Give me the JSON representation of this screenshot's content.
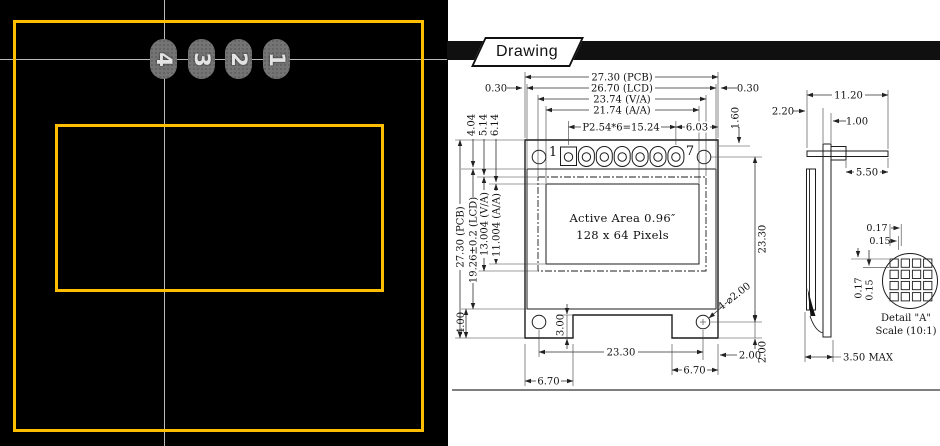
{
  "photo": {
    "pad_labels": [
      "4",
      "3",
      "2",
      "1"
    ],
    "colors": {
      "outline_yellow": "#FFBE00",
      "background": "#000000",
      "pad_gray": "#747474",
      "guide_line": "#DCDCDC"
    }
  },
  "banner": {
    "label": "Drawing"
  },
  "front_view": {
    "pin_first": "1",
    "pin_last": "7",
    "active_line1": "Active Area 0.96″",
    "active_line2": "128 x 64 Pixels",
    "dim_pcb_w": "27.30 (PCB)",
    "dim_lcd_w": "26.70 (LCD)",
    "dim_va_w": "23.74 (V/A)",
    "dim_aa_w": "21.74 (A/A)",
    "dim_pitch": "P2.54*6=15.24",
    "dim_pin_edge": "6.03",
    "dim_edge_l": "0.30",
    "dim_edge_r": "0.30",
    "dim_pin_top": "1.60",
    "dim_pcb_h": "27.30 (PCB)",
    "dim_lcd_h": "19.26±0.2 (LCD)",
    "dim_va_h": "13.004 (V/A)",
    "dim_aa_h": "11.004 (A/A)",
    "dim_glass_top": "4.04",
    "dim_va_top": "5.14",
    "dim_aa_top": "6.14",
    "dim_glass_bot": "4.00",
    "dim_notch": "3.00",
    "dim_hole_span_h": "23.30",
    "dim_hole_span_v": "23.30",
    "dim_tab_l": "6.70",
    "dim_tab_r": "6.70",
    "dim_hole_x": "2.00",
    "dim_hole_y": "2.00",
    "dim_holes": "4-⌀2.00"
  },
  "side_view": {
    "dim_pin_len": "11.20",
    "dim_pin_front": "2.20",
    "dim_pcb_t": "1.00",
    "dim_pin_back": "5.50",
    "dim_total": "3.50 MAX"
  },
  "detail_a": {
    "dim_px_pitch_h": "0.17",
    "dim_px_size_h": "0.15",
    "dim_px_pitch_v": "0.17",
    "dim_px_size_v": "0.15",
    "title": "Detail \"A\"",
    "scale": "Scale (10:1)"
  }
}
